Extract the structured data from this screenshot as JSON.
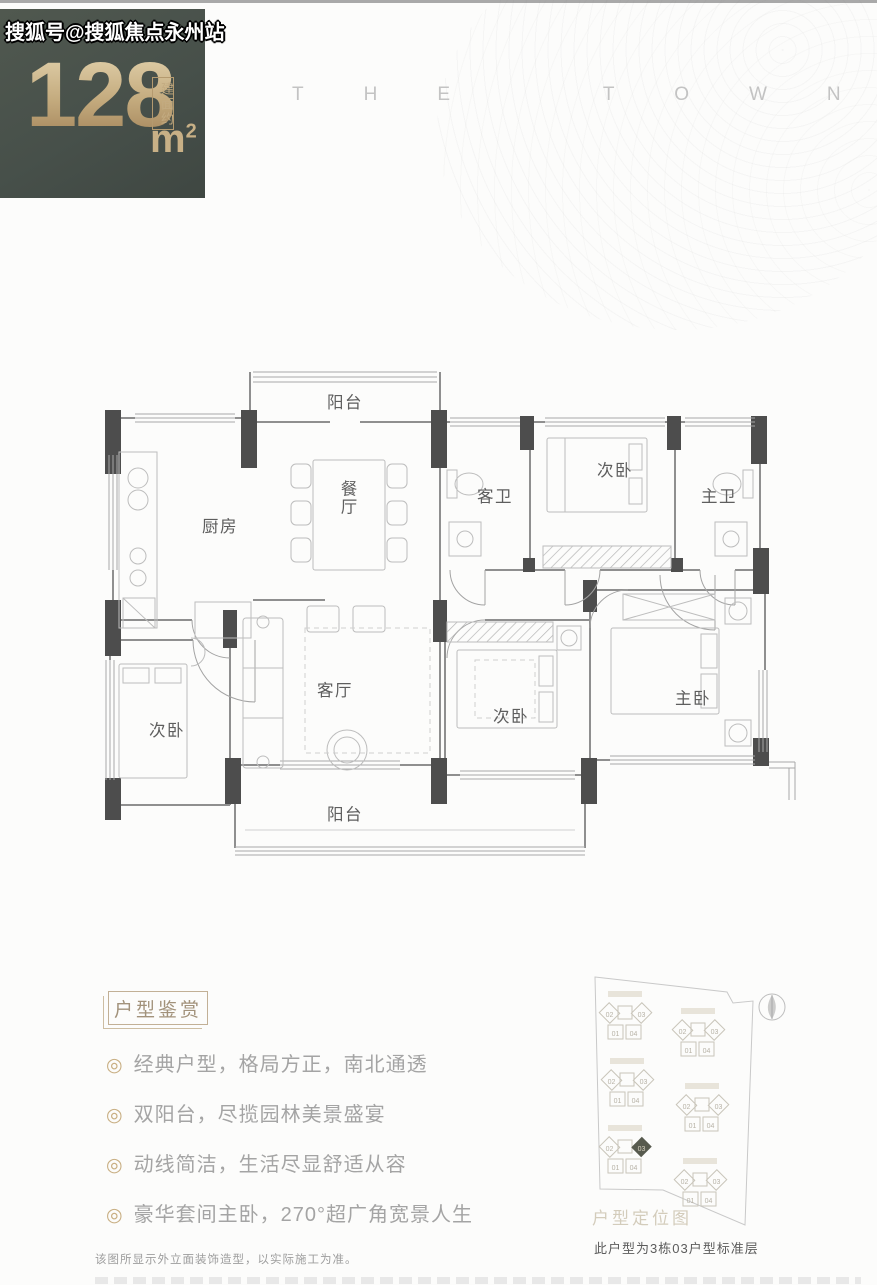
{
  "watermark": "搜狐号@搜狐焦点永州站",
  "brand": {
    "text": "THE TOWN"
  },
  "badge": {
    "area_value": "128",
    "area_prefix": "建面约",
    "unit_base": "m",
    "unit_sup": "2"
  },
  "floorplan": {
    "labels": {
      "balcony_top": "阳台",
      "kitchen": "厨房",
      "dining": "餐厅",
      "guest_bath": "客卫",
      "bedroom_top": "次卧",
      "master_bath": "主卫",
      "bedroom_left": "次卧",
      "living": "客厅",
      "bedroom_mid": "次卧",
      "master_bedroom": "主卧",
      "balcony_bottom": "阳台"
    }
  },
  "highlights": {
    "title": "户型鉴赏",
    "bullet": "◎",
    "items": [
      "经典户型，格局方正，南北通透",
      "双阳台，尽揽园林美景盛宴",
      "动线简洁，生活尽显舒适从容",
      "豪华套间主卧，270°超广角宽景人生"
    ]
  },
  "siteplan": {
    "caption": "户型定位图",
    "note": "此户型为3栋03户型标准层",
    "unit_numbers": [
      "02",
      "03",
      "01",
      "04"
    ],
    "highlight_unit": "03"
  },
  "disclaimer": "该图所显示外立面装饰造型，以实际施工为准。",
  "colors": {
    "badge_bg": "#47504a",
    "gold": "#c8b086",
    "wall_dark": "#4d4d4d",
    "wall_line": "#8f8f8f"
  }
}
